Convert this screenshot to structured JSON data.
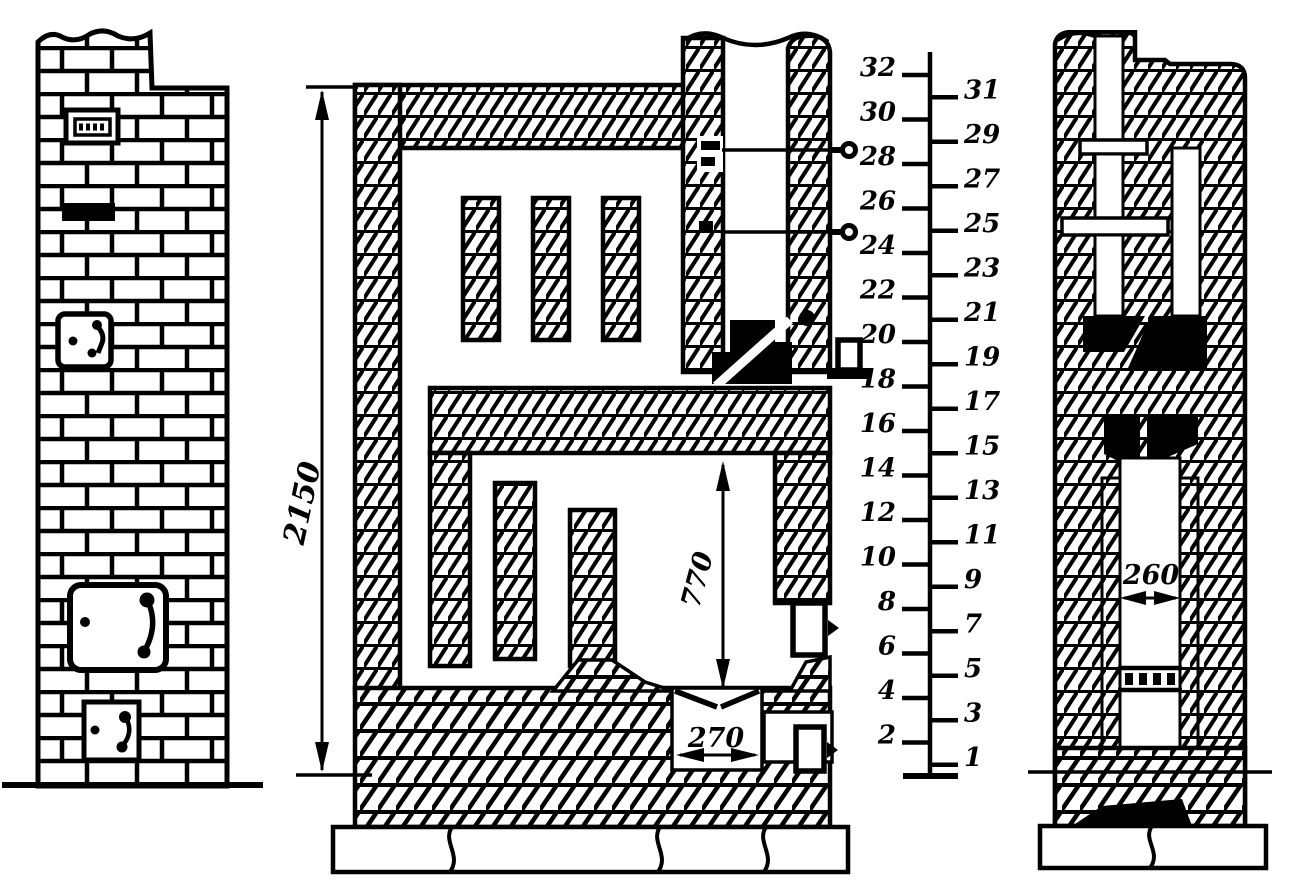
{
  "drawing": {
    "kind": "masonry-stove-sections",
    "dimensions": {
      "overall_height": "2150",
      "firebox_height": "770",
      "hearth_throat_width": "270",
      "flue_channel_width": "260"
    },
    "course_scale": {
      "rows": [
        1,
        2,
        3,
        4,
        5,
        6,
        7,
        8,
        9,
        10,
        11,
        12,
        13,
        14,
        15,
        16,
        17,
        18,
        19,
        20,
        21,
        22,
        23,
        24,
        25,
        26,
        27,
        28,
        29,
        30,
        31,
        32
      ]
    }
  }
}
